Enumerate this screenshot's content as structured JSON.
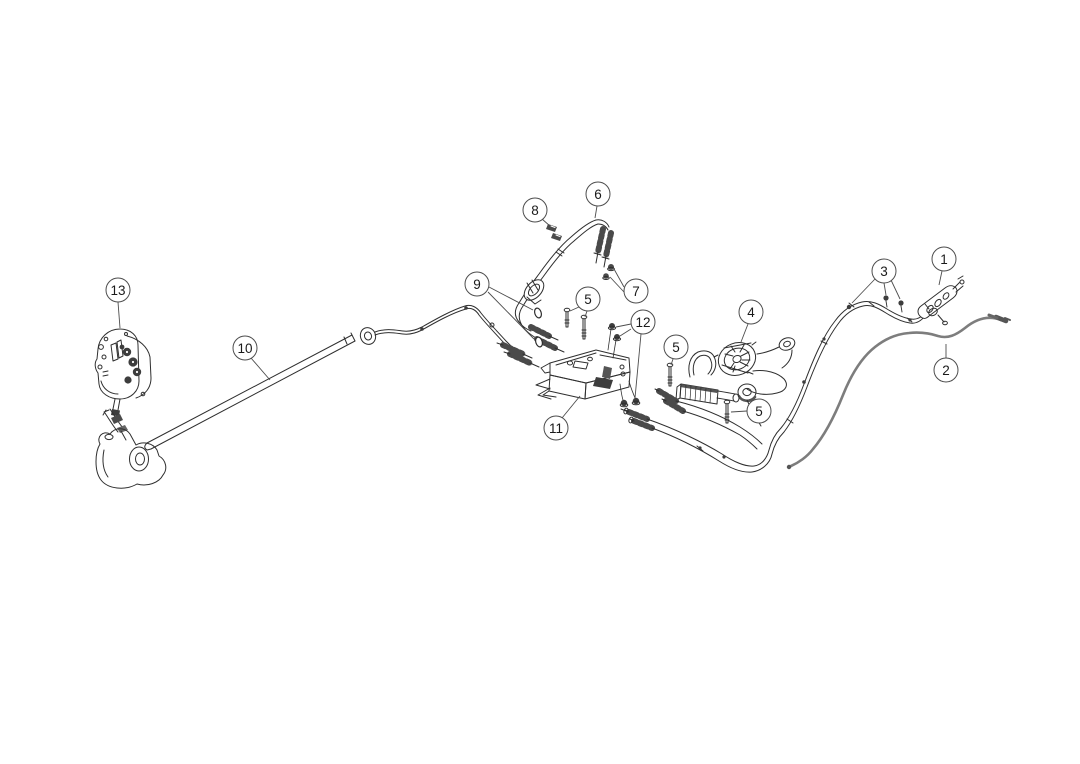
{
  "diagram": {
    "type": "exploded-parts-line-diagram",
    "background": "#ffffff",
    "line_color": "#2f2f2f",
    "dark_fill_color": "#3d3d3d",
    "gray_cable_color": "#7d7d7d",
    "callout_style": {
      "fill": "#ffffff",
      "stroke": "#4d4d4d",
      "text_color": "#1a1a1a",
      "radius": 12,
      "font_size": 13.5,
      "leader_width": 0.9
    },
    "callouts": [
      {
        "label": "1",
        "part": "cable-end-connector",
        "cx": 944,
        "cy": 259,
        "leaders": [
          [
            942,
            271,
            939,
            285
          ]
        ]
      },
      {
        "label": "2",
        "part": "gray-control-cable",
        "cx": 946,
        "cy": 370,
        "leaders": [
          [
            946,
            358,
            946,
            344
          ]
        ]
      },
      {
        "label": "3",
        "part": "cable-retaining-clips",
        "cx": 884,
        "cy": 271,
        "leaders": [
          [
            875,
            279,
            852,
            303
          ],
          [
            884,
            283,
            886,
            295
          ],
          [
            891,
            280,
            900,
            299
          ]
        ]
      },
      {
        "label": "4",
        "part": "hydraulic-pump-unit",
        "cx": 751,
        "cy": 312,
        "leaders": [
          [
            748,
            324,
            741,
            342
          ]
        ]
      },
      {
        "label": "5",
        "part": "mounting-bolts",
        "cx": 588,
        "cy": 299,
        "leaders": [
          [
            579,
            307,
            570,
            311
          ],
          [
            587,
            311,
            585,
            317
          ]
        ]
      },
      {
        "label": "5",
        "part": "mounting-bolt",
        "cx": 676,
        "cy": 347,
        "leaders": [
          [
            673,
            359,
            671,
            365
          ]
        ]
      },
      {
        "label": "5",
        "part": "mounting-bolt",
        "cx": 759,
        "cy": 411,
        "leaders": [
          [
            747,
            411,
            731,
            412
          ]
        ]
      },
      {
        "label": "6",
        "part": "hose-assembly",
        "cx": 598,
        "cy": 194,
        "leaders": [
          [
            597,
            206,
            595,
            218
          ]
        ]
      },
      {
        "label": "7",
        "part": "hex-nuts",
        "cx": 636,
        "cy": 291,
        "leaders": [
          [
            624,
            287,
            614,
            269
          ],
          [
            624,
            292,
            610,
            277
          ]
        ]
      },
      {
        "label": "8",
        "part": "spring-clips",
        "cx": 535,
        "cy": 210,
        "leaders": [
          [
            542,
            219,
            550,
            226
          ]
        ]
      },
      {
        "label": "9",
        "part": "grommet-rings",
        "cx": 477,
        "cy": 284,
        "leaders": [
          [
            489,
            287,
            533,
            310
          ],
          [
            488,
            292,
            534,
            339
          ]
        ]
      },
      {
        "label": "10",
        "part": "long-pipe-with-cable",
        "cx": 245,
        "cy": 348,
        "leaders": [
          [
            251,
            358,
            270,
            380
          ]
        ]
      },
      {
        "label": "11",
        "part": "mounting-bracket",
        "cx": 556,
        "cy": 428,
        "leaders": [
          [
            562,
            418,
            580,
            396
          ]
        ]
      },
      {
        "label": "12",
        "part": "push-nuts",
        "cx": 643,
        "cy": 322,
        "leaders": [
          [
            631,
            324,
            616,
            327
          ],
          [
            631,
            329,
            620,
            336
          ],
          [
            641,
            334,
            635,
            398
          ]
        ]
      },
      {
        "label": "13",
        "part": "control-module-bracket",
        "cx": 118,
        "cy": 290,
        "leaders": [
          [
            118,
            302,
            120,
            328
          ]
        ]
      }
    ]
  }
}
